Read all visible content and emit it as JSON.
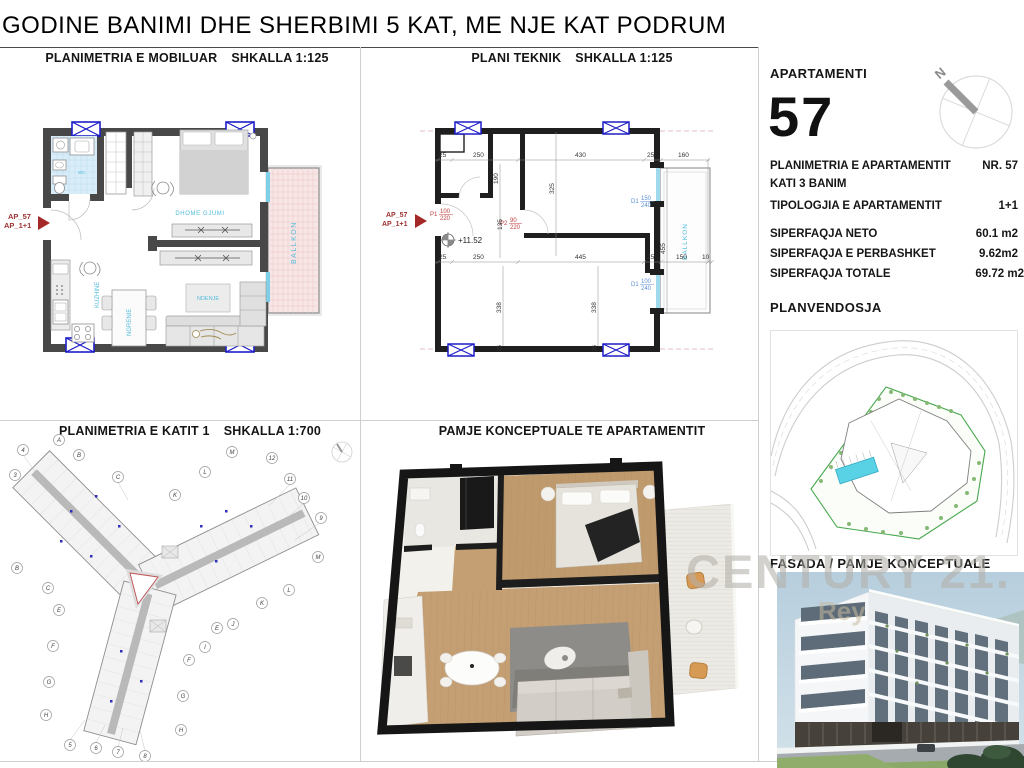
{
  "title": "GODINE BANIMI DHE SHERBIMI 5 KAT, ME NJE KAT PODRUM",
  "panels": {
    "furnished": {
      "title": "PLANIMETRIA E MOBILUAR",
      "scale": "SHKALLA 1:125"
    },
    "technical": {
      "title": "PLANI TEKNIK",
      "scale": "SHKALLA 1:125"
    },
    "floor1": {
      "title": "PLANIMETRIA E KATIT 1",
      "scale": "SHKALLA 1:700"
    },
    "render3d": {
      "title": "PAMJE KONCEPTUALE TE APARTAMENTIT"
    }
  },
  "sidebar": {
    "apartment_label": "APARTAMENTI",
    "apartment_number": "57",
    "info": [
      {
        "label": "PLANIMETRIA E APARTAMENTIT",
        "value": "NR. 57"
      },
      {
        "label": "KATI 3 BANIM",
        "value": ""
      },
      {
        "label": "TIPOLOGJIA E APARTAMENTIT",
        "value": "1+1"
      }
    ],
    "areas": [
      {
        "label": "SIPERFAQJA NETO",
        "value": "60.1 m2"
      },
      {
        "label": "SIPERFAQJA E PERBASHKET",
        "value": "9.62m2"
      },
      {
        "label": "SIPERFAQJA TOTALE",
        "value": "69.72 m2"
      }
    ],
    "siteplan_label": "PLANVENDOSJA",
    "fasada_label": "FASADA / PAMJE KONCEPTUALE"
  },
  "compass_n": "N",
  "apartment_marker": {
    "line1": "AP_57",
    "line2": "AP_1+1"
  },
  "rooms": {
    "bedroom": "DHOME GJUMI",
    "kitchen": "KUZHINE",
    "dining": "NGRENIE",
    "living": "NDENJE",
    "balcony": "BALLKON",
    "bath": "WC"
  },
  "technical": {
    "level": "+11.52",
    "p1": "P1",
    "p1_w": "100",
    "p1_h": "220",
    "p2": "P2",
    "p2_w": "90",
    "p2_h": "220",
    "d1a": "D1",
    "d1a_w": "150",
    "d1a_h": "240",
    "d1b": "D1",
    "d1b_w": "100",
    "d1b_h": "240",
    "dims": {
      "t1": "25",
      "t2": "250",
      "t3": "430",
      "t4": "25",
      "t5": "160",
      "m1": "25",
      "m2": "250",
      "m3": "445",
      "m4": "25",
      "m5": "150",
      "m6": "10",
      "v1": "190",
      "v2": "325",
      "v3": "135",
      "v4": "455",
      "v5": "338",
      "v6": "338",
      "b1": "25",
      "b2": "25"
    }
  },
  "floor1": {
    "axes": [
      "4",
      "A",
      "B",
      "C",
      "K",
      "L",
      "M",
      "12",
      "11",
      "10",
      "9",
      "M",
      "3",
      "B",
      "C",
      "E",
      "F",
      "G",
      "H",
      "L",
      "K",
      "J",
      "E",
      "I",
      "F",
      "G",
      "H",
      "5",
      "6",
      "7",
      "8"
    ]
  },
  "watermark": {
    "line1": "CENTURY 21.",
    "line2": "Rey"
  }
}
